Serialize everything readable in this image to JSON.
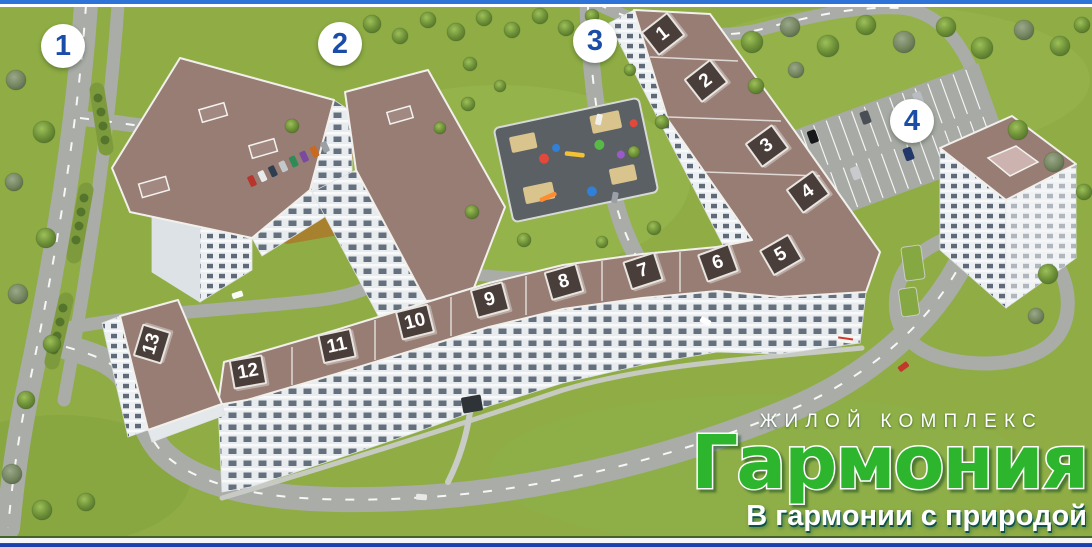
{
  "map": {
    "area_markers": [
      "1",
      "2",
      "3",
      "4"
    ],
    "section_plates": [
      "1",
      "2",
      "3",
      "4",
      "5",
      "6",
      "7",
      "8",
      "9",
      "10",
      "11",
      "12",
      "13"
    ]
  },
  "logo": {
    "kicker": "ЖИЛОЙ КОМПЛЕКС",
    "name": "Гармония",
    "tagline": "В гармонии с природой"
  },
  "colors": {
    "frame_top_blue": "#2e74d8",
    "frame_bottom_blue": "#1c3fae",
    "logo_green": "#2db52d",
    "marker_number_blue": "#1b4da8",
    "plate_background": "#4a3e3a",
    "grass": "#8fad44",
    "roof_mauve": "#977d73",
    "road_gray": "#a9aca7"
  }
}
